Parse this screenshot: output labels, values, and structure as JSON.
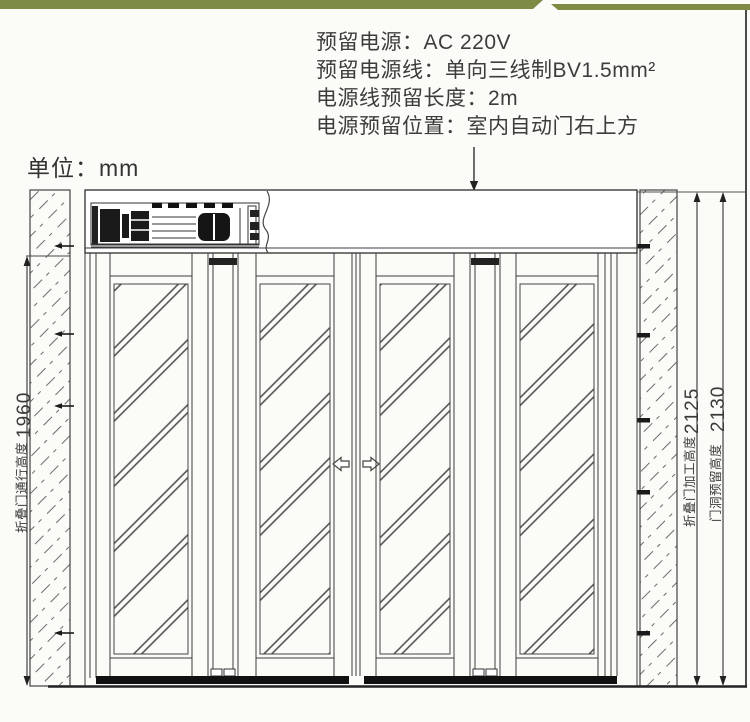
{
  "page": {
    "bg": "#fbfbf8",
    "accent_green": "#7d8b45",
    "line_color": "#3c3c3c"
  },
  "power_notes": {
    "lines": [
      "预留电源：AC 220V",
      "预留电源线：单向三线制BV1.5mm²",
      "电源线预留长度：2m",
      "电源预留位置：室内自动门右上方"
    ]
  },
  "unit_label": "单位：mm",
  "dimensions": {
    "passage_height": {
      "label": "折叠门通行高度",
      "value": "1960"
    },
    "fabrication_height": {
      "label": "折叠门加工高度",
      "value": "2125"
    },
    "opening_height": {
      "label": "门洞预留高度",
      "value": "2130"
    }
  }
}
